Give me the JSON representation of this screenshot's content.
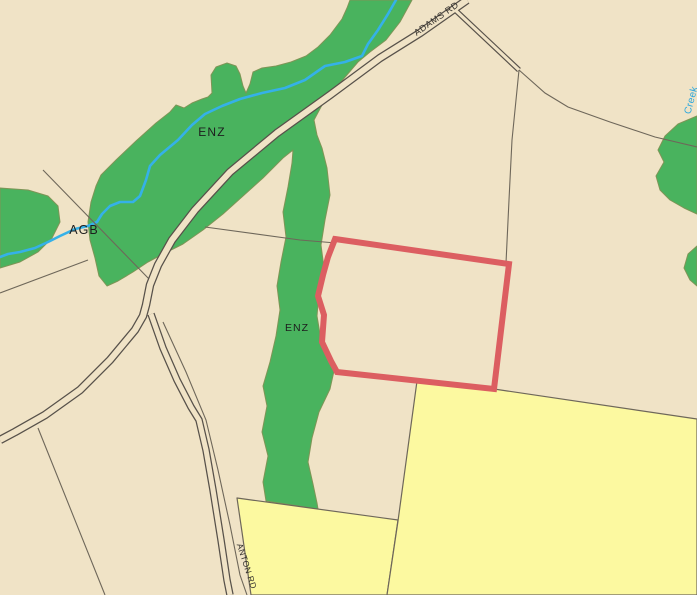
{
  "map": {
    "labels": {
      "adams_rd": "ADAMS RD",
      "anton_rd": "ANTON RD",
      "enz_upper": "ENZ",
      "enz_strip": "ENZ",
      "agb": "AGB",
      "creek": "Creek"
    },
    "colors": {
      "base_parcel": "#f0e3c6",
      "zone_green": "#49b35e",
      "zone_green_edge": "#7d9556",
      "zone_yellow": "#fcf9a0",
      "stream_blue": "#35b1e8",
      "road_casing": "#57514a",
      "boundary_line": "#6e675a",
      "selected_parcel_red": "#dc5e61",
      "zone_label_text": "#1d1d1d",
      "road_label_text": "#33302c",
      "creek_label_text": "#2ba7de"
    }
  }
}
